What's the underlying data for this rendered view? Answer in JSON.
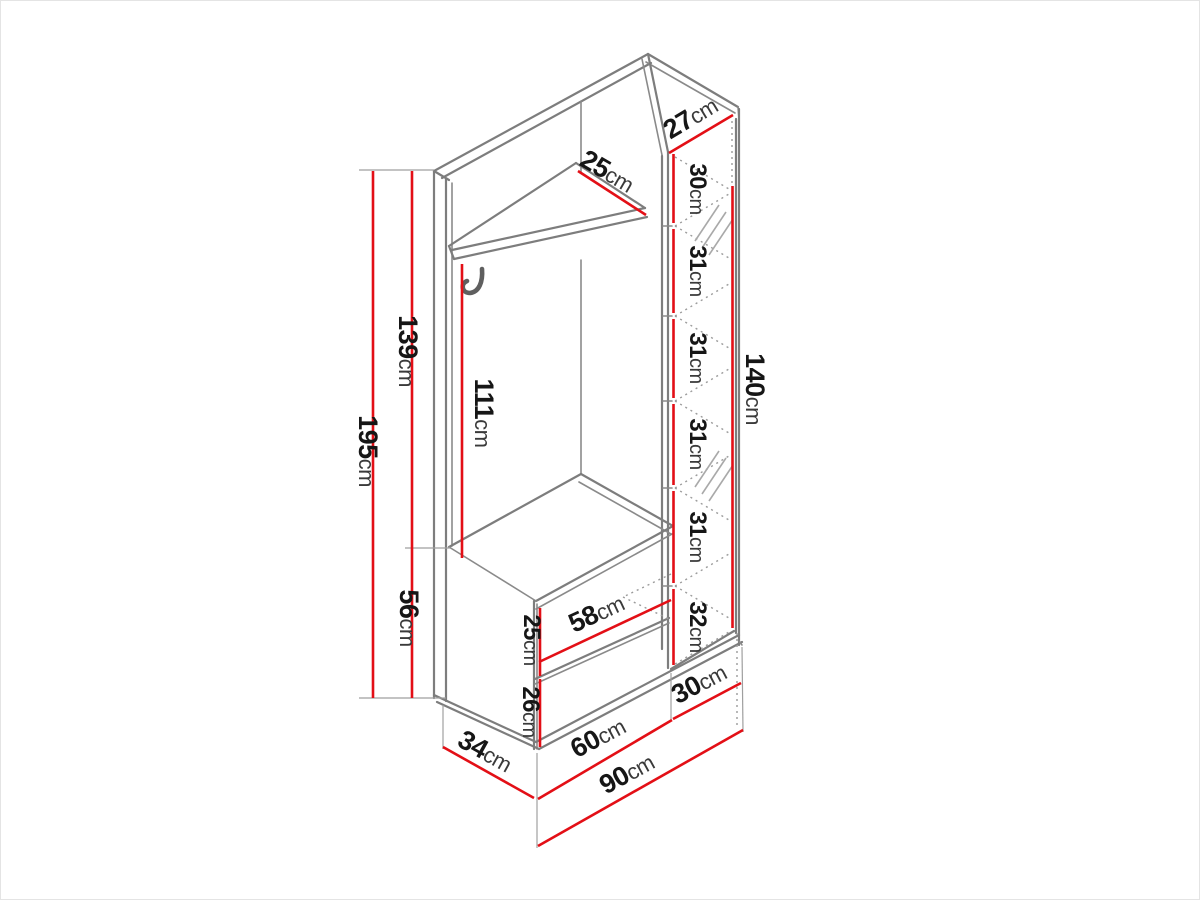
{
  "colors": {
    "dimension_red": "#e30f16",
    "structure_gray": "#7d7d7d",
    "background": "#ffffff"
  },
  "dims": {
    "total_height": {
      "value": "195",
      "unit": "cm"
    },
    "upper_height": {
      "value": "139",
      "unit": "cm"
    },
    "lower_height": {
      "value": "56",
      "unit": "cm"
    },
    "hanging_height": {
      "value": "111",
      "unit": "cm"
    },
    "shelf_depth": {
      "value": "25",
      "unit": "cm"
    },
    "column_top_depth": {
      "value": "27",
      "unit": "cm"
    },
    "column_seg1": {
      "value": "30",
      "unit": "cm"
    },
    "column_seg2": {
      "value": "31",
      "unit": "cm"
    },
    "column_seg3": {
      "value": "31",
      "unit": "cm"
    },
    "column_seg4": {
      "value": "31",
      "unit": "cm"
    },
    "column_seg5": {
      "value": "31",
      "unit": "cm"
    },
    "column_seg6": {
      "value": "32",
      "unit": "cm"
    },
    "mirror_column_height": {
      "value": "140",
      "unit": "cm"
    },
    "drawer_width": {
      "value": "58",
      "unit": "cm"
    },
    "drawer_front_height": {
      "value": "25",
      "unit": "cm"
    },
    "base_height": {
      "value": "26",
      "unit": "cm"
    },
    "side_depth": {
      "value": "34",
      "unit": "cm"
    },
    "bench_width": {
      "value": "60",
      "unit": "cm"
    },
    "column_width": {
      "value": "30",
      "unit": "cm"
    },
    "total_width": {
      "value": "90",
      "unit": "cm"
    }
  }
}
